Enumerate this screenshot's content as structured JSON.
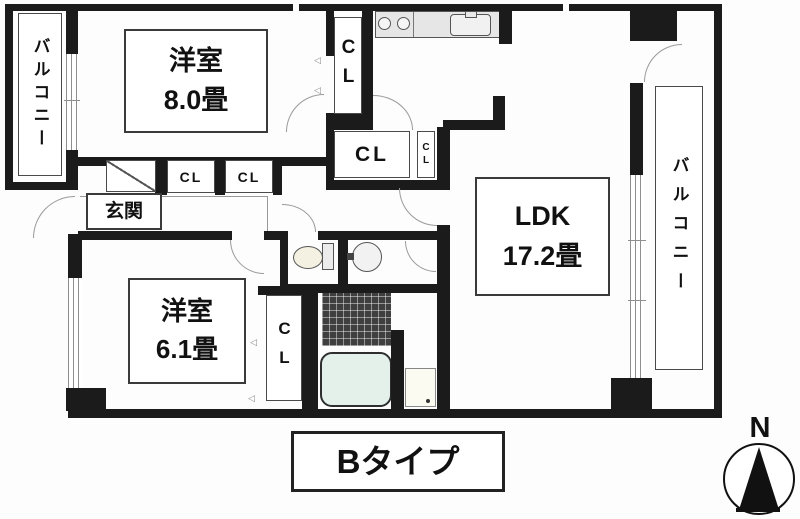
{
  "plan": {
    "type_label": "Bタイプ",
    "compass_label": "N",
    "rooms": {
      "balcony_left": {
        "label": "バルコニー"
      },
      "balcony_right": {
        "label": "バルコニー"
      },
      "bedroom_large": {
        "name": "洋室",
        "size": "8.0畳"
      },
      "bedroom_small": {
        "name": "洋室",
        "size": "6.1畳"
      },
      "ldk": {
        "name": "LDK",
        "size": "17.2畳"
      },
      "entrance": {
        "label": "玄関"
      }
    },
    "closets": {
      "tall": "CL",
      "hall": "CL",
      "hall_small": "CL",
      "genkan_a": "CL",
      "genkan_b": "CL",
      "bedroom_small_cl": "CL"
    },
    "colors": {
      "wall": "#1b1b1b",
      "bathtub": "#e4f1ea",
      "counter": "#e6e6e6",
      "tile": "#3f3f3f",
      "winline": "#8f8f8f",
      "arc": "#9a9a9a"
    }
  }
}
